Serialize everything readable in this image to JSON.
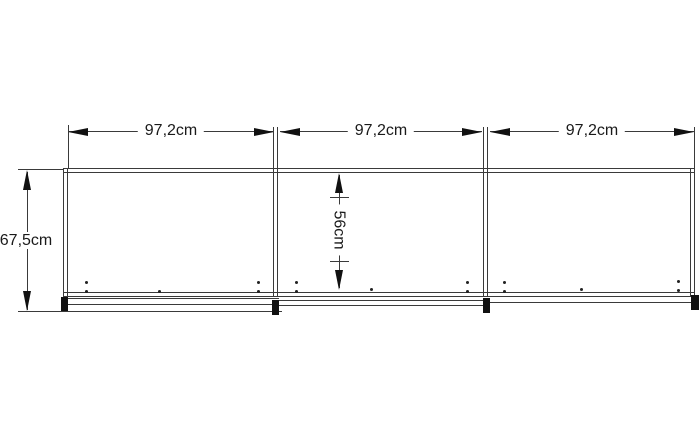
{
  "dimensions": {
    "section_widths": [
      "97,2cm",
      "97,2cm",
      "97,2cm"
    ],
    "total_height": "67,5cm",
    "inner_height": "56cm"
  },
  "colors": {
    "background": "#ffffff",
    "line": "#3a3a3a",
    "arrow": "#111111",
    "text": "#1a1a1a"
  }
}
